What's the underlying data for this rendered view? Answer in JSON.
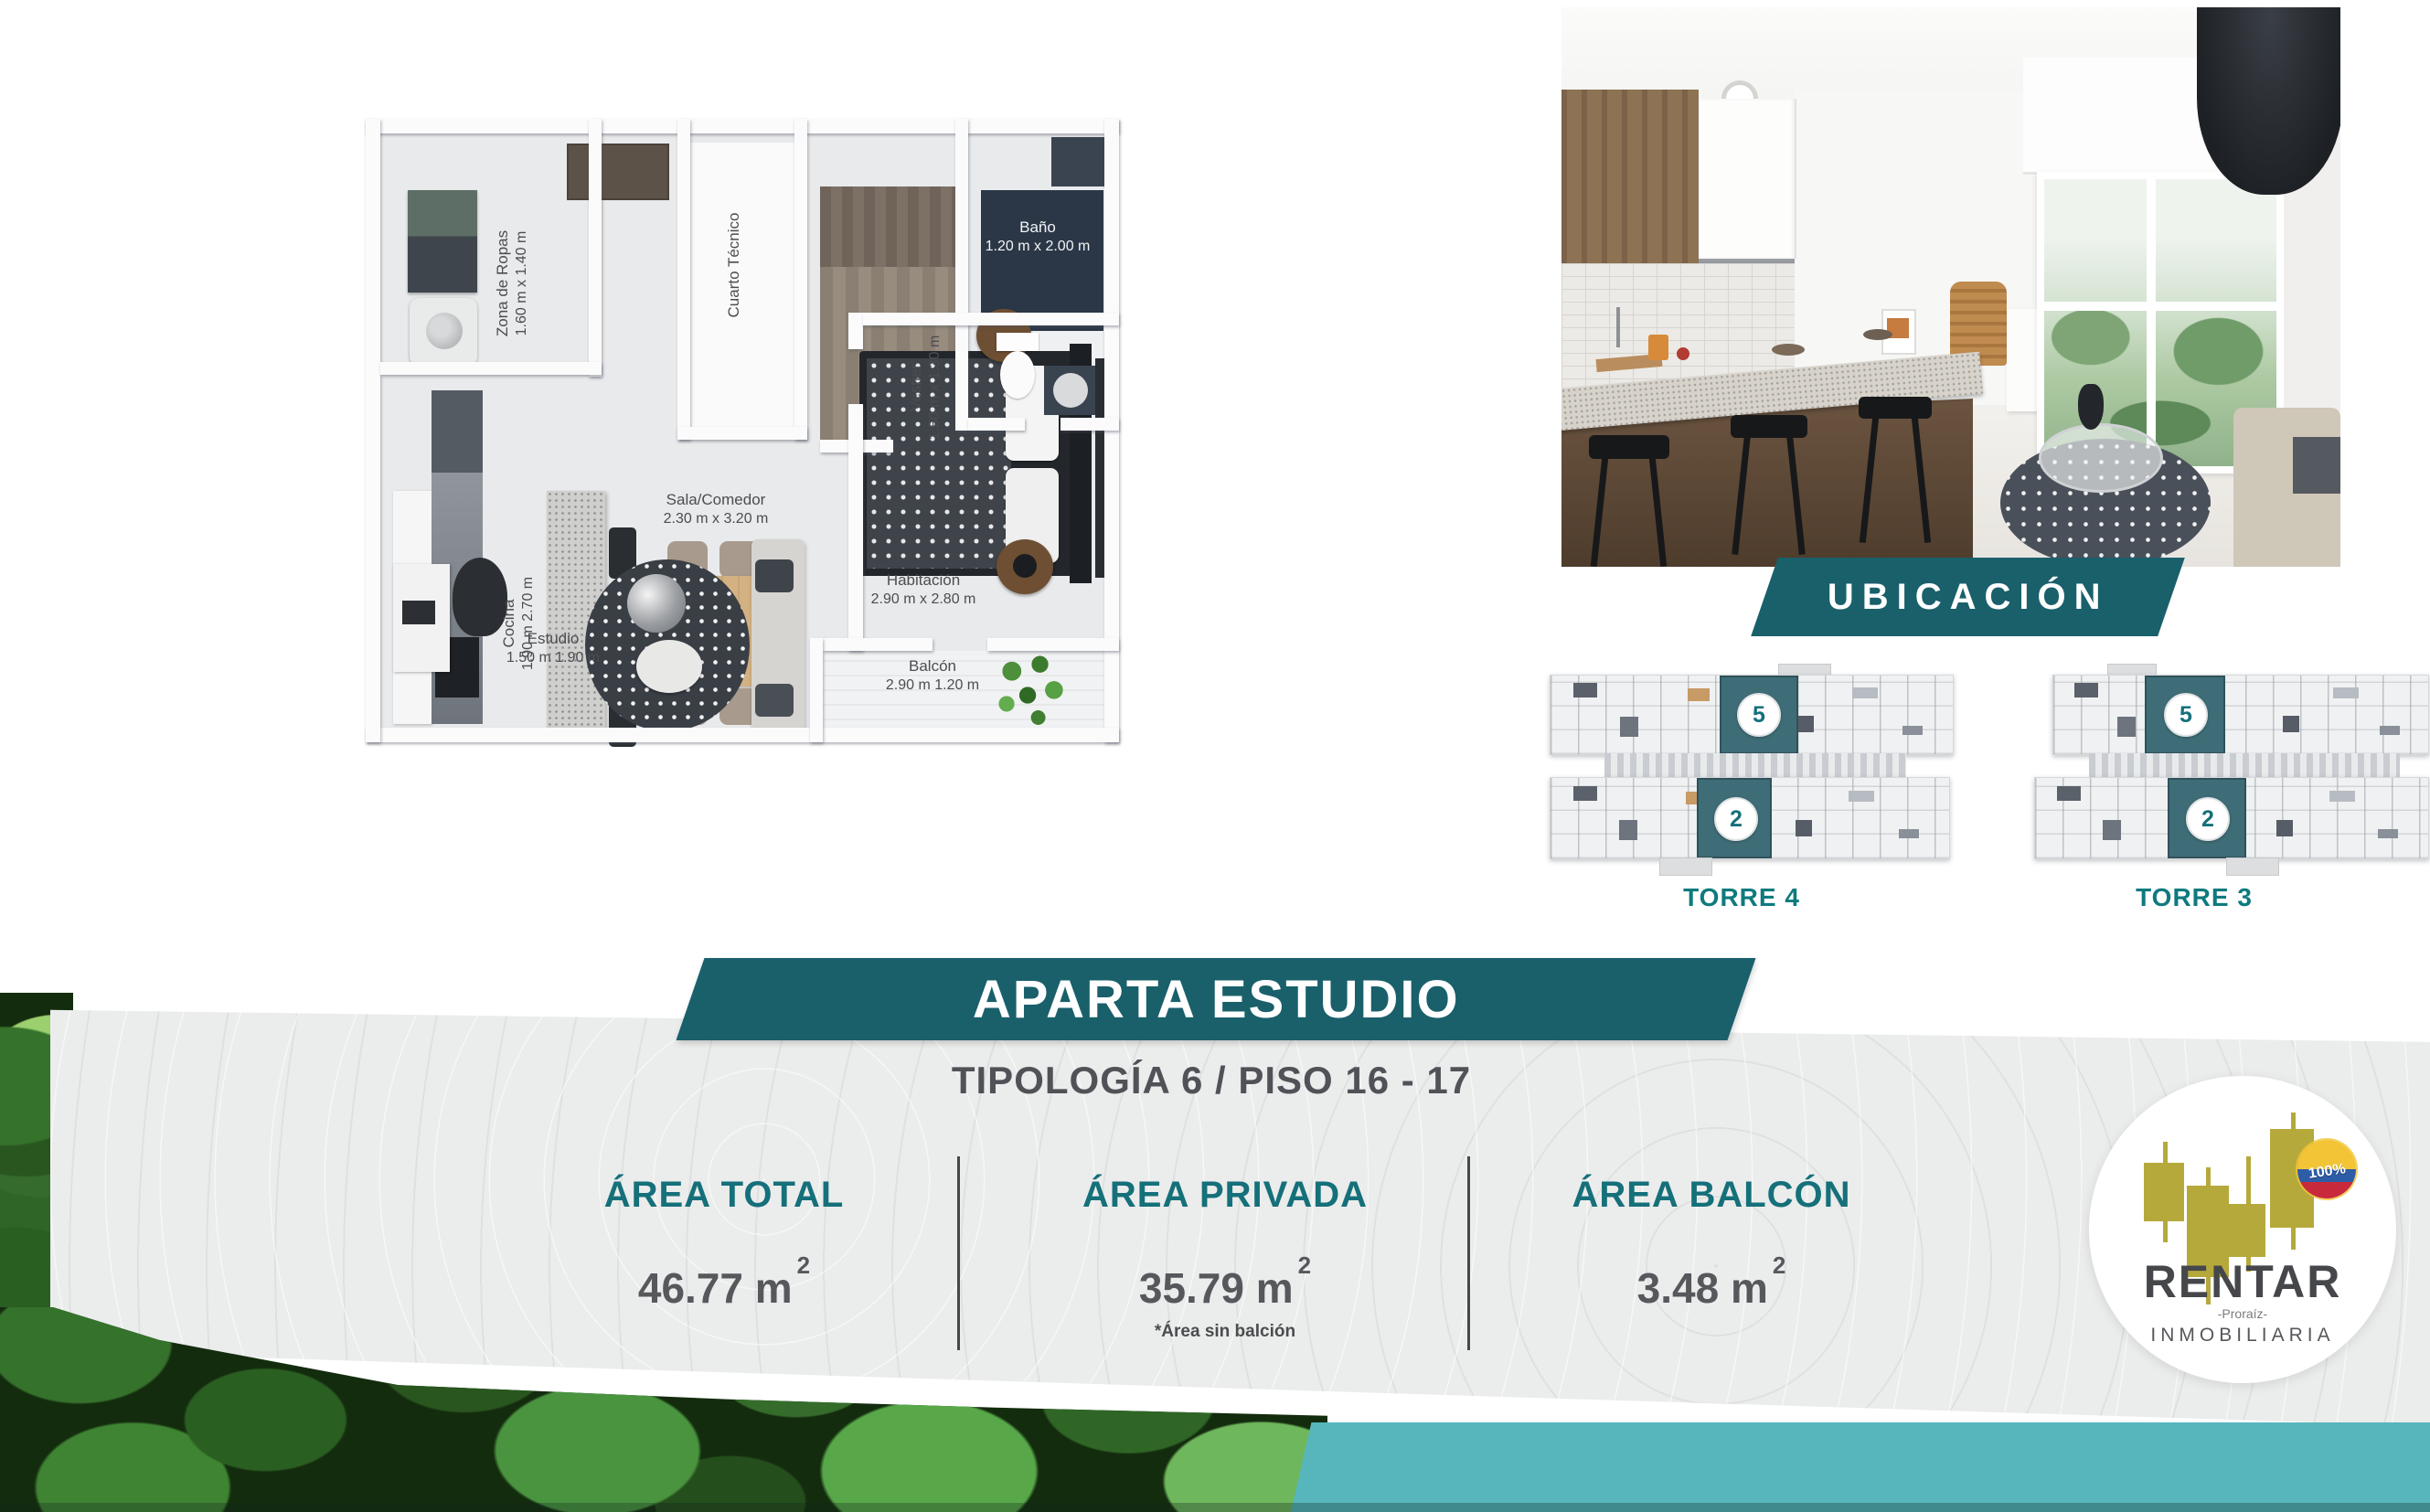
{
  "floor_plan": {
    "rooms": [
      {
        "name": "Zona de Ropas",
        "dims": "1.60 m x 1.40 m"
      },
      {
        "name": "Cuarto Técnico",
        "dims": ""
      },
      {
        "name": "Vestier",
        "dims": "1.50 m x 1.30 m"
      },
      {
        "name": "Baño",
        "dims": "1.20 m x 2.00 m"
      },
      {
        "name": "Cocina",
        "dims": "1.90 m 2.70 m"
      },
      {
        "name": "Sala/Comedor",
        "dims": "2.30 m x 3.20 m"
      },
      {
        "name": "Estudio",
        "dims": "1.50 m 1.90 m"
      },
      {
        "name": "Habitación",
        "dims": "2.90 m x 2.80 m"
      },
      {
        "name": "Balcón",
        "dims": "2.90 m 1.20 m"
      }
    ]
  },
  "ubicacion": {
    "title": "UBICACIÓN",
    "towers": [
      {
        "label": "TORRE 4",
        "unit_top": "5",
        "unit_bottom": "2"
      },
      {
        "label": "TORRE 3",
        "unit_top": "5",
        "unit_bottom": "2"
      }
    ]
  },
  "banner": {
    "title": "APARTA ESTUDIO",
    "subtitle": "TIPOLOGÍA 6 / PISO 16 - 17"
  },
  "areas": [
    {
      "label": "ÁREA TOTAL",
      "value": "46.77 m",
      "sup": "2",
      "note": ""
    },
    {
      "label": "ÁREA PRIVADA",
      "value": "35.79 m",
      "sup": "2",
      "note": "*Área sin balción"
    },
    {
      "label": "ÁREA BALCÓN",
      "value": "3.48 m",
      "sup": "2",
      "note": ""
    }
  ],
  "logo": {
    "brand": "RENTAR",
    "tagline": "-Proraíz-",
    "type": "INMOBILIARIA",
    "badge_percent": "100%"
  },
  "colors": {
    "teal_banner": "#19606b",
    "teal_heading": "#15707a",
    "teal_torre": "#0e7a7e",
    "teal_band": "#57b6bc",
    "unit_highlight": "#3f6d77",
    "text_gray": "#57585c",
    "logo_gold": "#b6a93c"
  }
}
